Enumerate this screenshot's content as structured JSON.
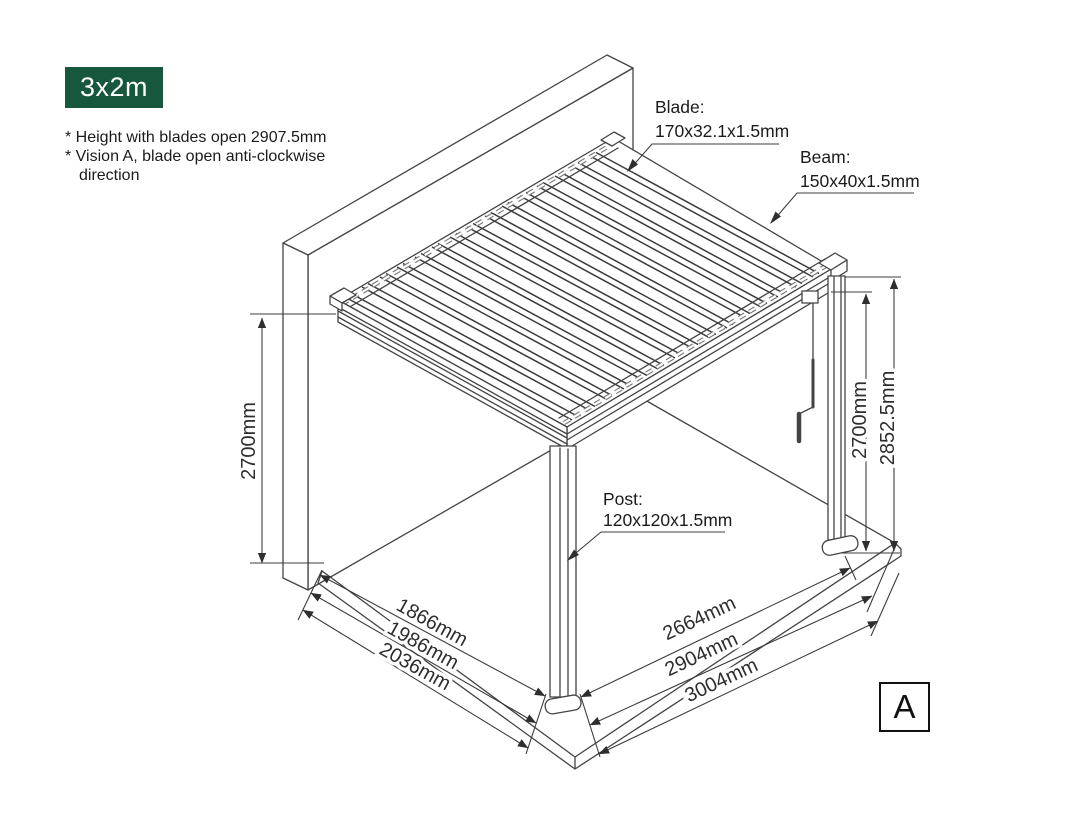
{
  "badge": {
    "label": "3x2m",
    "bg_color": "#17583c",
    "text_color": "#ffffff"
  },
  "notes": {
    "line1": "* Height with blades open 2907.5mm",
    "line2": "* Vision A, blade open anti-clockwise",
    "line3": "direction"
  },
  "labels": {
    "blade": {
      "title": "Blade:",
      "spec": "170x32.1x1.5mm"
    },
    "beam": {
      "title": "Beam:",
      "spec": "150x40x1.5mm"
    },
    "post": {
      "title": "Post:",
      "spec": "120x120x1.5mm"
    }
  },
  "dimensions": {
    "left_height": "2700mm",
    "right_height_inner": "2700mm",
    "right_height_outer": "2852.5mm",
    "bottom_left": [
      "1866mm",
      "1986mm",
      "2036mm"
    ],
    "bottom_right": [
      "2664mm",
      "2904mm",
      "3004mm"
    ]
  },
  "view_marker": "A",
  "drawing": {
    "stroke_color": "#444444",
    "dim_color": "#2e2e2e"
  }
}
